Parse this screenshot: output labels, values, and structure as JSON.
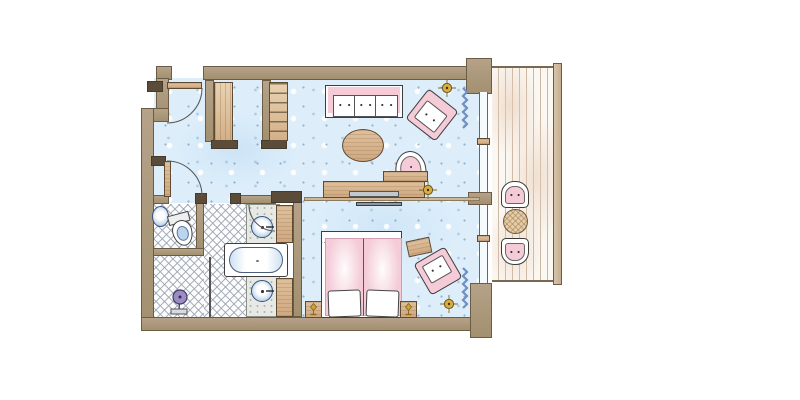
{
  "drawing": {
    "kind": "architectural-floor-plan",
    "style": "hand-drawn watercolor",
    "visible_text": "none"
  },
  "colors": {
    "floor": "#ddeefa",
    "wall": "#ab9880",
    "wallEdge": "#6d5c45",
    "capDark": "#5b4c39",
    "wood": "#d9b68d",
    "woodEdge": "#5f4a33",
    "pink": "#f4cbd7",
    "gold": "#d2a336",
    "fixtureBlue": "#bcd4ec",
    "deck": "#fbf7f2",
    "deckLine": "#cbb7a2",
    "lattice": "#96a0af",
    "curtain": "#6f8fc0",
    "shower": "#9b8cc6",
    "ink": "#3e3e3e"
  },
  "areas": [
    {
      "name": "living-bedroom",
      "floor": "blue speckled carpet"
    },
    {
      "name": "bathroom",
      "floor": "white with diagonal lattice tiles"
    },
    {
      "name": "balcony",
      "floor": "wood deck planks"
    }
  ],
  "elements": [
    {
      "name": "entry-door",
      "symbol": "door leaf with swing arc"
    },
    {
      "name": "bathroom-door",
      "symbol": "door leaf with swing arc"
    },
    {
      "name": "wardrobe-closet",
      "count": 2
    },
    {
      "name": "sofa",
      "cushions": 3,
      "color": "pink"
    },
    {
      "name": "armchair",
      "count": 2,
      "color": "pink"
    },
    {
      "name": "coffee-table-oval",
      "material": "wood"
    },
    {
      "name": "desk-console",
      "material": "wood"
    },
    {
      "name": "desk-chair-round",
      "color": "pink"
    },
    {
      "name": "double-bed",
      "mattresses": 2,
      "bedding": "pink duvets, white pillows"
    },
    {
      "name": "nightstand-with-lamp",
      "count": 2
    },
    {
      "name": "ceiling-light-symbol",
      "count": 3,
      "color": "gold"
    },
    {
      "name": "curtain-squiggle",
      "count": 2,
      "color": "blue"
    },
    {
      "name": "bathtub"
    },
    {
      "name": "washbasin",
      "count": 2
    },
    {
      "name": "toilet"
    },
    {
      "name": "wc-corner-sink"
    },
    {
      "name": "shower-head-symbol",
      "color": "purple"
    },
    {
      "name": "balcony-chair",
      "count": 2,
      "color": "pink"
    },
    {
      "name": "balcony-round-table",
      "material": "wicker"
    }
  ]
}
